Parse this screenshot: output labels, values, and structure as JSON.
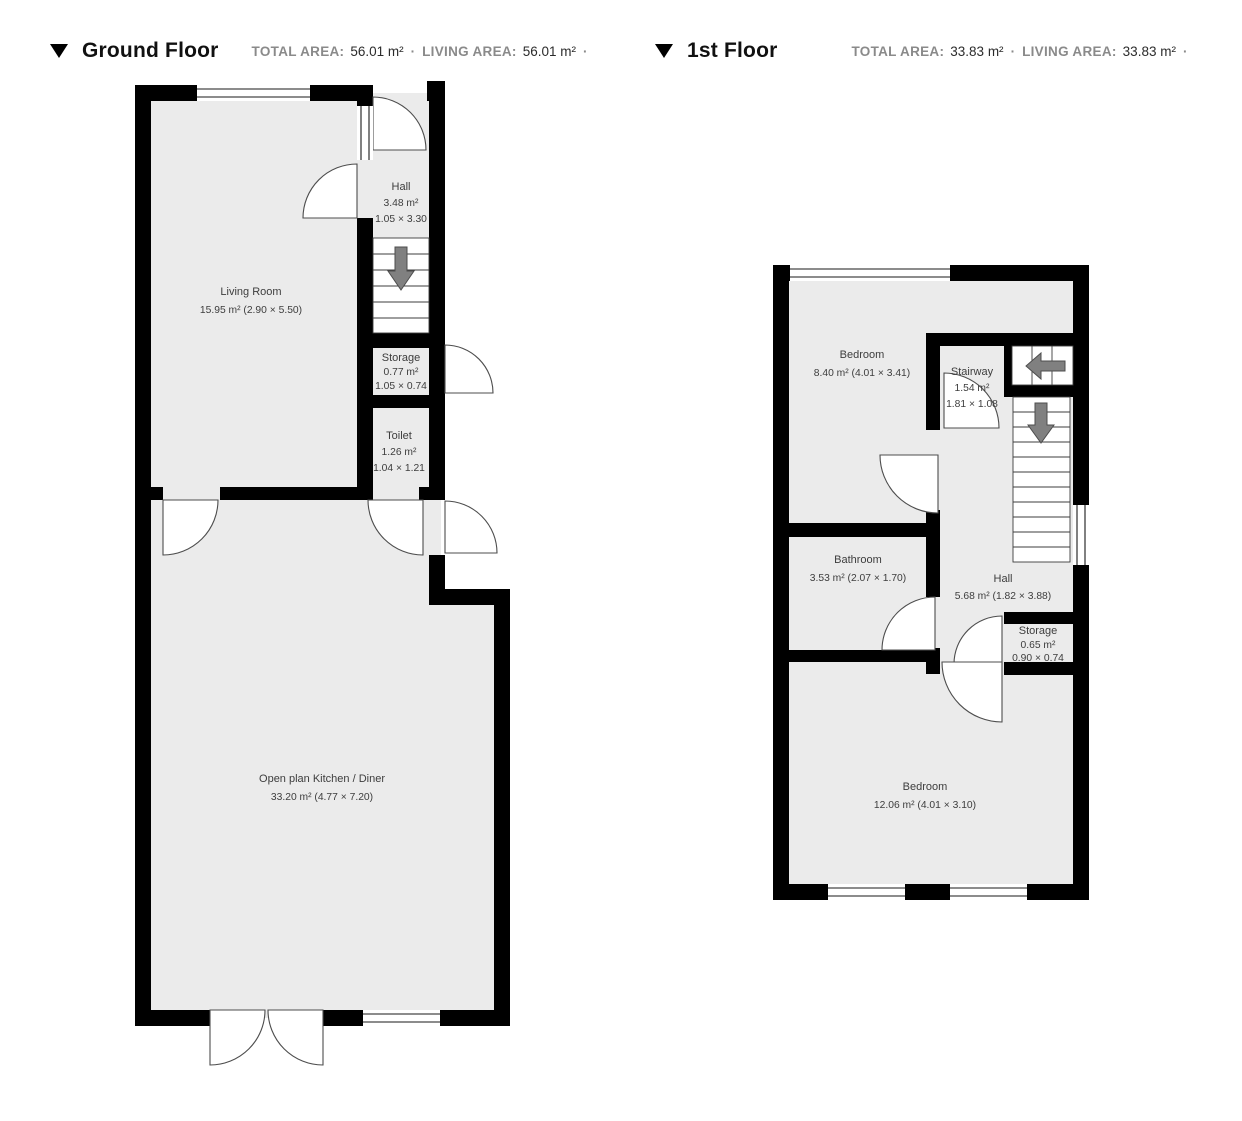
{
  "colors": {
    "wall": "#000000",
    "room_fill": "#ebebeb",
    "arrow_fill": "#808080",
    "label_text": "#3d3d3d",
    "header_muted": "#8a8a8a",
    "header_dark": "#2b2b2b"
  },
  "floors": {
    "ground": {
      "title": "Ground Floor",
      "stats": {
        "total_area_label": "TOTAL AREA:",
        "total_area_value": "56.01 m²",
        "dot1": "·",
        "living_area_label": "LIVING AREA:",
        "living_area_value": "56.01 m²",
        "dot2": "·"
      },
      "rooms": {
        "hall": {
          "name": "Hall",
          "area": "3.48 m²",
          "dims": "1.05 × 3.30"
        },
        "living_room": {
          "name": "Living Room",
          "area_dims": "15.95 m² (2.90 × 5.50)"
        },
        "storage": {
          "name": "Storage",
          "area": "0.77 m²",
          "dims": "1.05 × 0.74"
        },
        "toilet": {
          "name": "Toilet",
          "area": "1.26 m²",
          "dims": "1.04 × 1.21"
        },
        "kitchen": {
          "name": "Open plan Kitchen / Diner",
          "area_dims": "33.20 m² (4.77 × 7.20)"
        }
      }
    },
    "first": {
      "title": "1st Floor",
      "stats": {
        "total_area_label": "TOTAL AREA:",
        "total_area_value": "33.83 m²",
        "dot1": "·",
        "living_area_label": "LIVING AREA:",
        "living_area_value": "33.83 m²",
        "dot2": "·"
      },
      "rooms": {
        "bedroom1": {
          "name": "Bedroom",
          "area_dims": "8.40 m² (4.01 × 3.41)"
        },
        "stairway": {
          "name": "Stairway",
          "area": "1.54 m²",
          "dims": "1.81 × 1.08"
        },
        "bathroom": {
          "name": "Bathroom",
          "area_dims": "3.53 m² (2.07 × 1.70)"
        },
        "hall": {
          "name": "Hall",
          "area_dims": "5.68 m² (1.82 × 3.88)"
        },
        "storage": {
          "name": "Storage",
          "area": "0.65 m²",
          "dims": "0.90 × 0.74"
        },
        "bedroom2": {
          "name": "Bedroom",
          "area_dims": "12.06 m² (4.01 × 3.10)"
        }
      }
    }
  }
}
